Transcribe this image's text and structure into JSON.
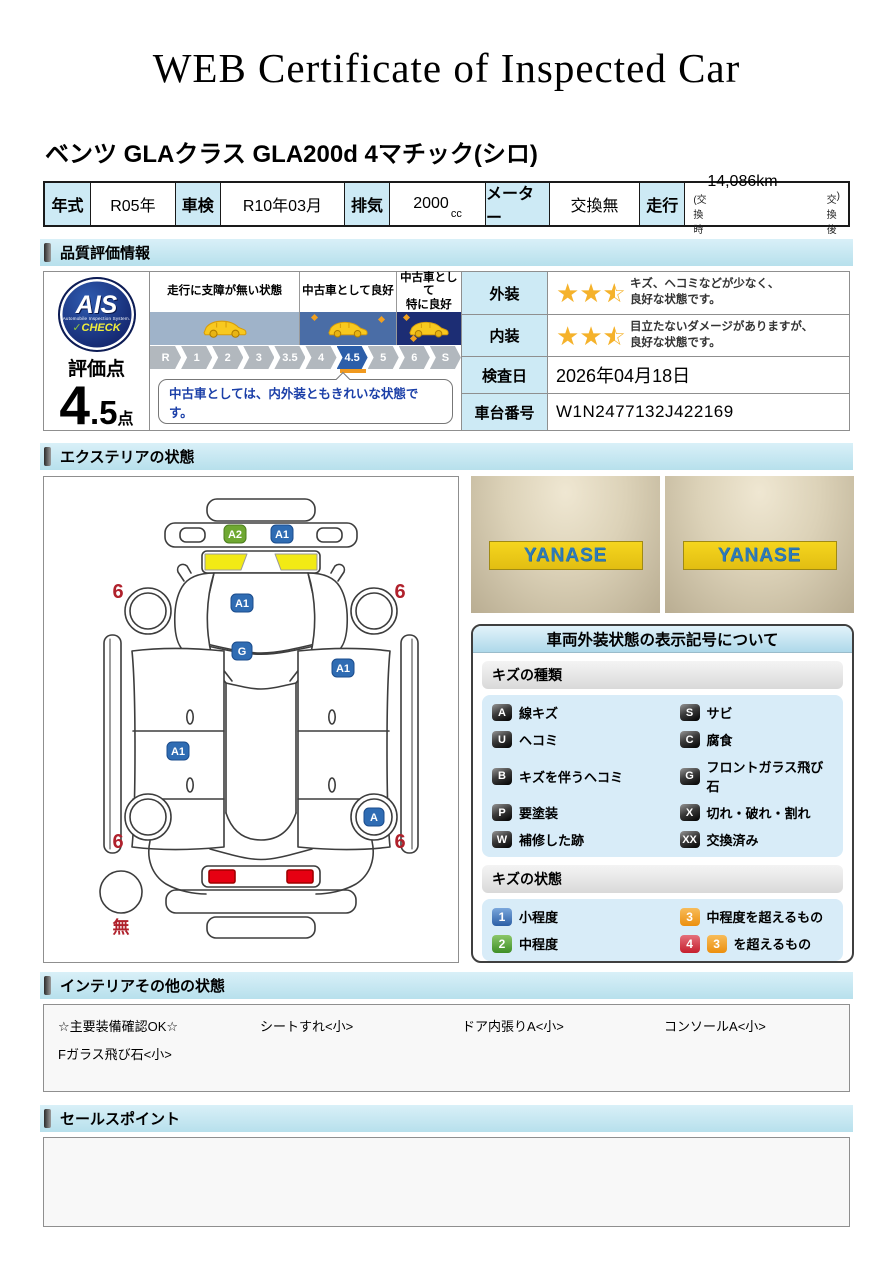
{
  "title": "WEB Certificate of Inspected Car",
  "car_name": "ベンツ GLAクラス GLA200d 4マチック(シロ)",
  "spec": {
    "year_label": "年式",
    "year_value": "R05年",
    "inspection_label": "車検",
    "inspection_value": "R10年03月",
    "displacement_label": "排気",
    "displacement_value": "2000",
    "displacement_unit": "cc",
    "meter_label": "メーター",
    "meter_value": "交換無",
    "mileage_label": "走行",
    "mileage_value": "14,086km",
    "mileage_note_left": "(交換時",
    "mileage_note_mid": "交換後",
    "mileage_note_right": ")"
  },
  "section_headers": {
    "quality": "品質評価情報",
    "exterior": "エクステリアの状態",
    "interior": "インテリアその他の状態",
    "sales": "セールスポイント"
  },
  "quality": {
    "ais_logo": {
      "text": "AIS",
      "subtext": "Automobile Inspection System.",
      "check_mark": "✓",
      "check_label": "CHECK"
    },
    "score_label": "評価点",
    "score_int": "4",
    "score_frac": ".5",
    "score_unit": "点",
    "zones": [
      {
        "line1": "走行に支障が無い状態",
        "line2": "",
        "band_color": "#9fb3c9"
      },
      {
        "line1": "中古車として良好",
        "line2": "",
        "band_color": "#4a6da6"
      },
      {
        "line1": "中古車として",
        "line2": "特に良好",
        "band_color": "#1c2d74"
      }
    ],
    "scale": [
      "R",
      "1",
      "2",
      "3",
      "3.5",
      "4",
      "4.5",
      "5",
      "6",
      "S"
    ],
    "scale_active": "4.5",
    "scale_marker_color": "#f0991e",
    "comment": "中古車としては、内外装ともきれいな状態です。",
    "exterior_row": {
      "label": "外装",
      "stars": 2.5,
      "comment_line1": "キズ、ヘコミなどが少なく、",
      "comment_line2": "良好な状態です。"
    },
    "interior_row": {
      "label": "内装",
      "stars": 2.5,
      "comment_line1": "目立たないダメージがありますが、",
      "comment_line2": "良好な状態です。"
    },
    "date_row": {
      "label": "検査日",
      "value": "2026年04月18日"
    },
    "vin_row": {
      "label": "車台番号",
      "value": "W1N2477132J422169"
    },
    "star_color": "#f5b22b"
  },
  "exterior": {
    "photos": [
      {
        "sign": "YANASE"
      },
      {
        "sign": "YANASE"
      }
    ],
    "diagram": {
      "markers": [
        "A2",
        "A1",
        "A1",
        "G",
        "A1",
        "A1",
        "A"
      ],
      "marker_blue": "#2f6cb3",
      "marker_green": "#6fa832",
      "wheel_flags": [
        "6",
        "6",
        "6",
        "6"
      ],
      "wheel_flag_color": "#b0212c",
      "spare_label": "無",
      "headlight_color": "#f2ea15",
      "taillight_color": "#e60012"
    },
    "legend": {
      "title": "車両外装状態の表示記号について",
      "kinds_header": "キズの種類",
      "kinds": [
        {
          "code": "A",
          "label": "線キズ"
        },
        {
          "code": "S",
          "label": "サビ"
        },
        {
          "code": "U",
          "label": "ヘコミ"
        },
        {
          "code": "C",
          "label": "腐食"
        },
        {
          "code": "B",
          "label": "キズを伴うヘコミ"
        },
        {
          "code": "G",
          "label": "フロントガラス飛び石"
        },
        {
          "code": "P",
          "label": "要塗装"
        },
        {
          "code": "X",
          "label": "切れ・破れ・割れ"
        },
        {
          "code": "W",
          "label": "補修した跡"
        },
        {
          "code": "XX",
          "label": "交換済み"
        }
      ],
      "states_header": "キズの状態",
      "states": [
        {
          "code": "1",
          "label": "小程度",
          "color": "#3b6fb5"
        },
        {
          "code": "3",
          "label": "中程度を超えるもの",
          "color": "#f09a26"
        },
        {
          "code": "2",
          "label": "中程度",
          "color": "#4f9c33"
        },
        {
          "code": "4",
          "code2": "3",
          "label": "を超えるもの",
          "color": "#d5303e",
          "color2": "#f09a26"
        }
      ]
    }
  },
  "interior": {
    "items": [
      "☆主要装備確認OK☆",
      "シートすれ<小>",
      "ドア内張りA<小>",
      "コンソールA<小>",
      "Fガラス飛び石<小>"
    ]
  },
  "sales": {
    "content": ""
  }
}
